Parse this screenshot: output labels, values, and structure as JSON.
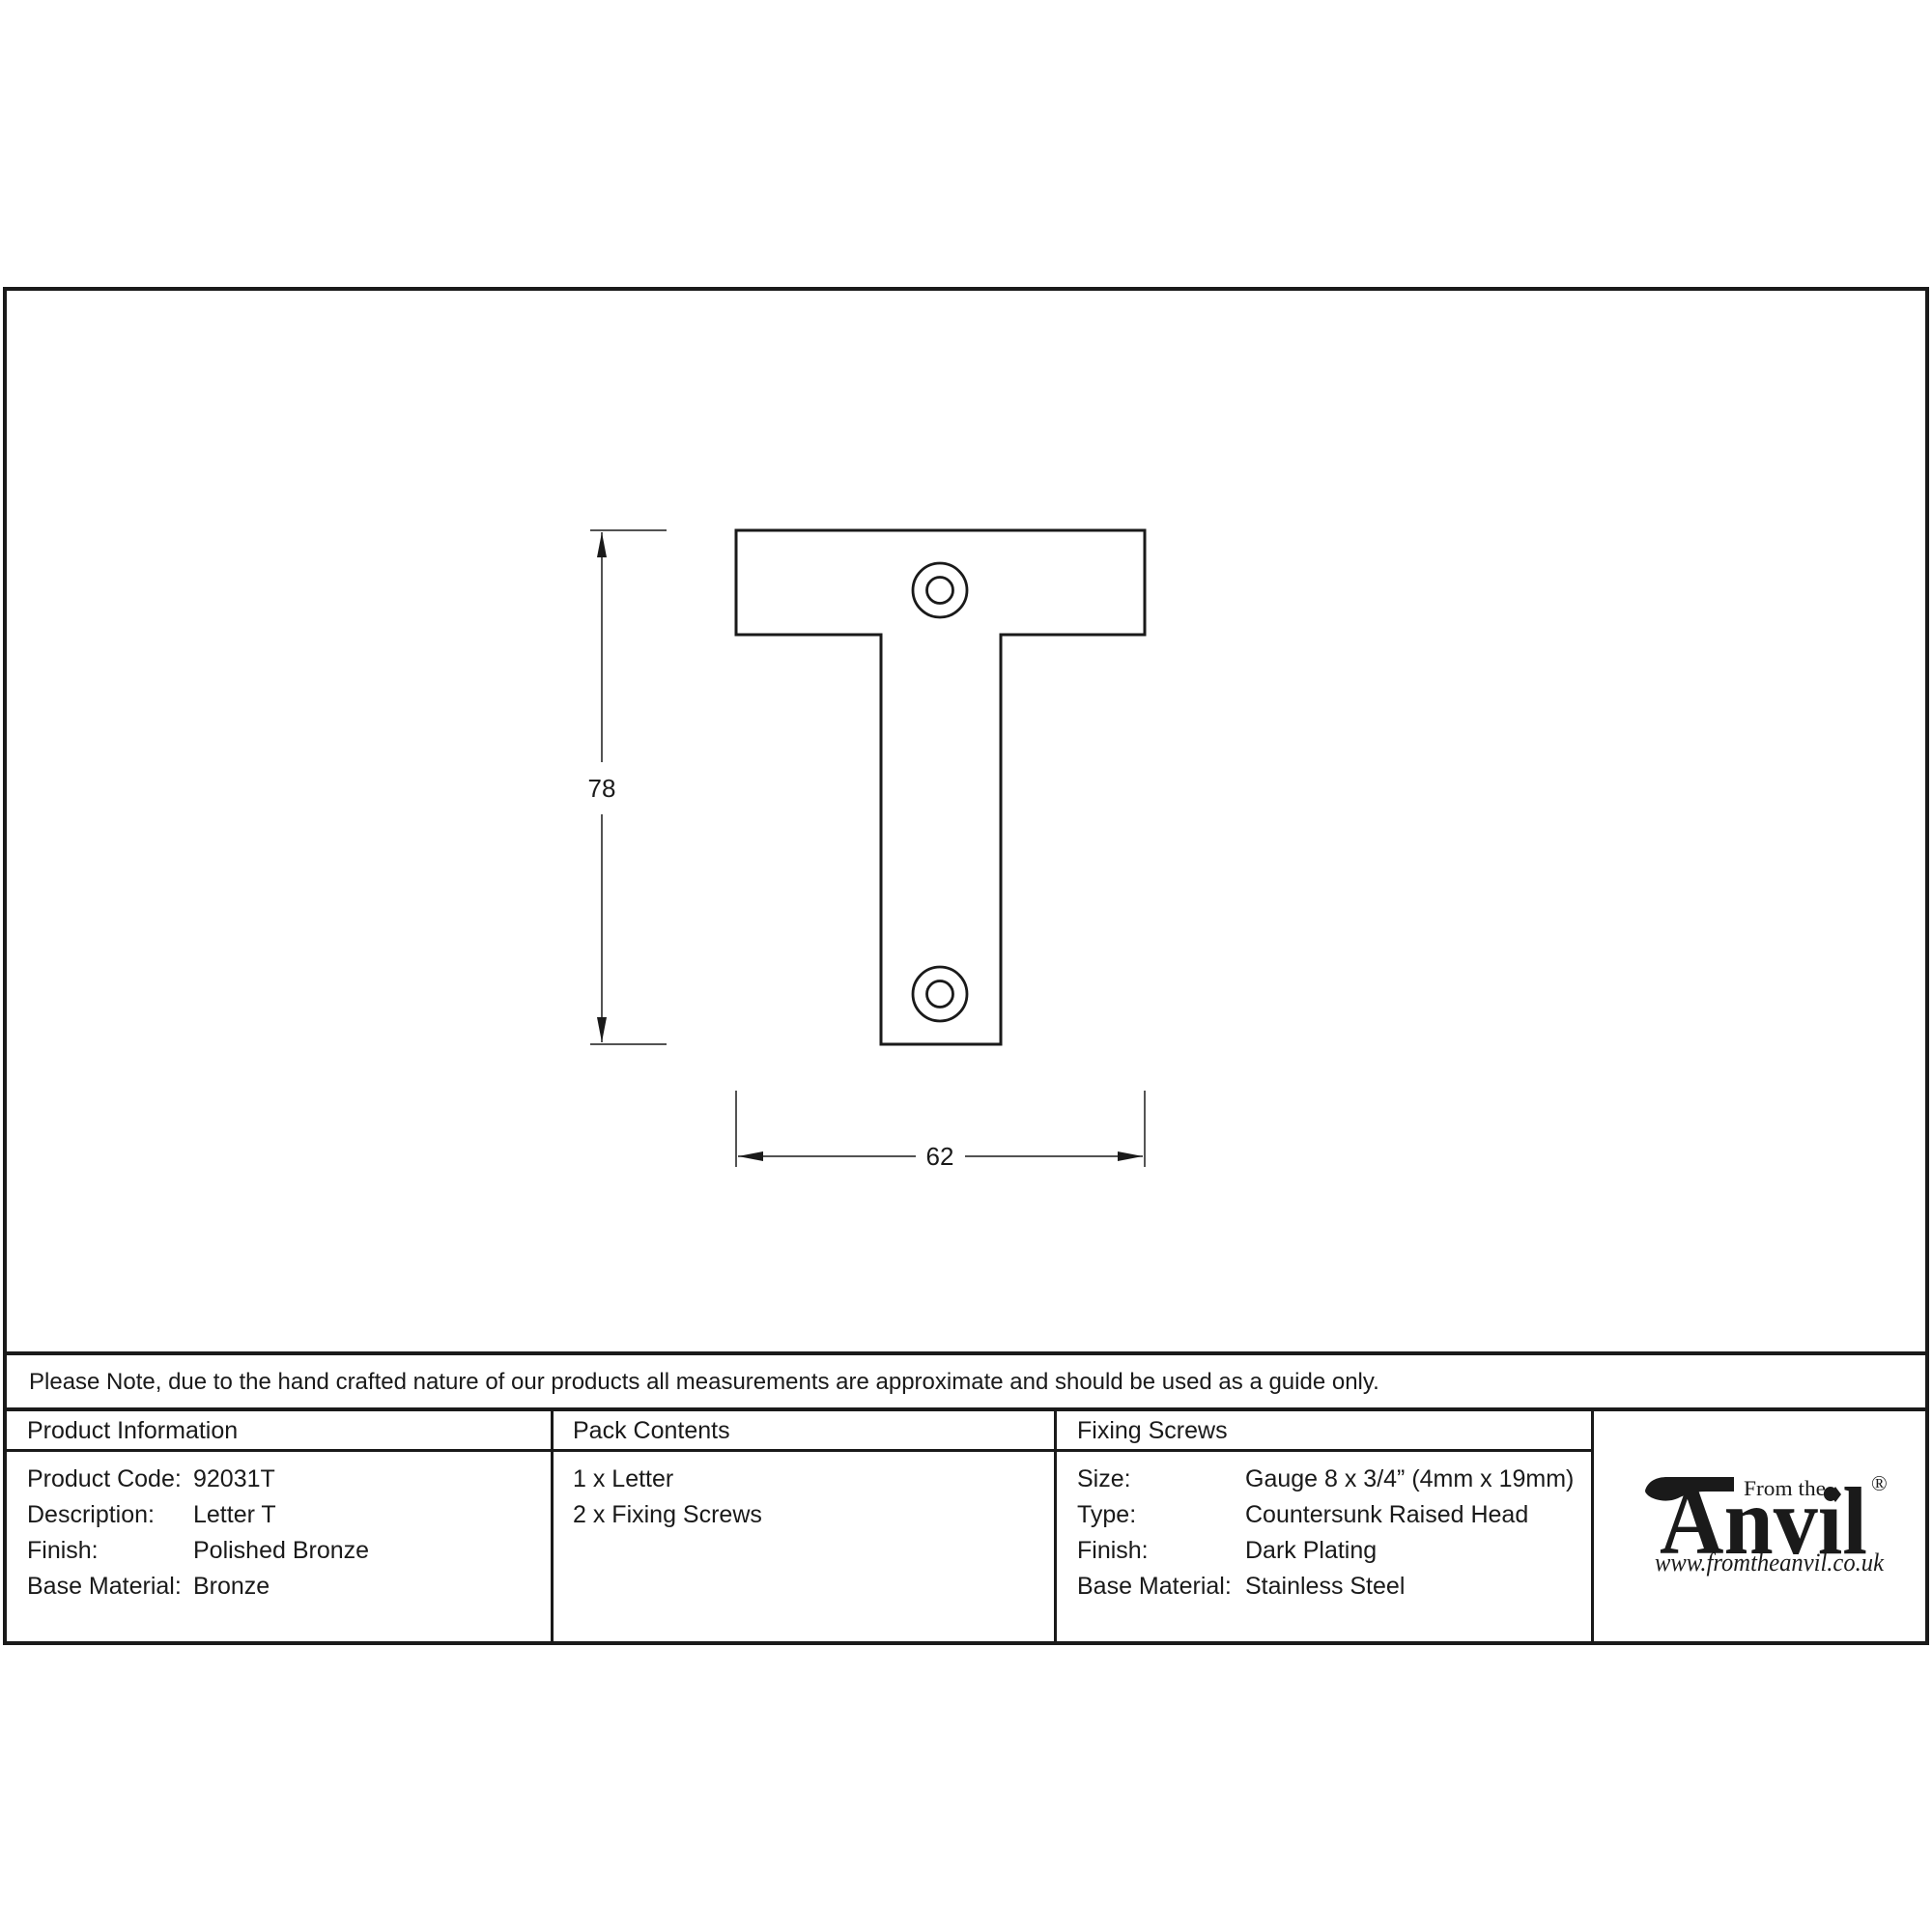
{
  "note": {
    "text": "Please Note, due to the hand crafted nature of our products all measurements are approximate and should be used as a guide only."
  },
  "drawing": {
    "height_dimension_label": "78",
    "width_dimension_label": "62"
  },
  "table": {
    "product_information": {
      "header": "Product Information",
      "rows": [
        {
          "label": "Product Code:",
          "value": "92031T"
        },
        {
          "label": "Description:",
          "value": "Letter T"
        },
        {
          "label": "Finish:",
          "value": "Polished Bronze"
        },
        {
          "label": "Base Material:",
          "value": "Bronze"
        }
      ]
    },
    "pack_contents": {
      "header": "Pack Contents",
      "items": [
        "1 x Letter",
        "2 x Fixing Screws"
      ]
    },
    "fixing_screws": {
      "header": "Fixing Screws",
      "rows": [
        {
          "label": "Size:",
          "value": "Gauge 8 x 3/4” (4mm x 19mm)"
        },
        {
          "label": "Type:",
          "value": "Countersunk Raised Head"
        },
        {
          "label": "Finish:",
          "value": "Dark Plating"
        },
        {
          "label": "Base Material:",
          "value": "Stainless Steel"
        }
      ]
    }
  },
  "logo": {
    "tagline": "From the",
    "brand": "Anvil",
    "registered_mark": "®",
    "url": "www.fromtheanvil.co.uk"
  },
  "colors": {
    "ink": "#1a1a1a",
    "paper": "#ffffff"
  }
}
